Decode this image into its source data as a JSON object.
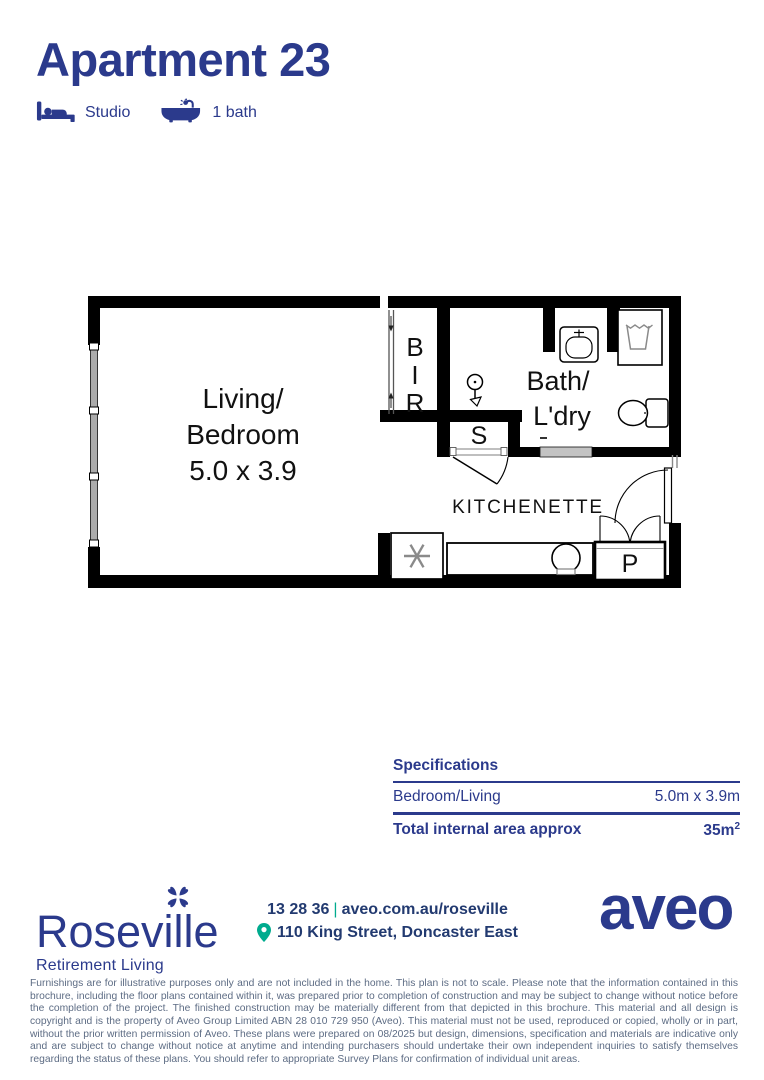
{
  "colors": {
    "navy": "#2b3a8c",
    "green": "#00ab8e",
    "disclaimer_gray": "#5d6c84",
    "wall": "#000000"
  },
  "header": {
    "title": "Apartment 23",
    "features": [
      {
        "icon": "bed-icon",
        "label": "Studio"
      },
      {
        "icon": "bath-icon",
        "label": "1 bath"
      }
    ]
  },
  "floorplan": {
    "labels": {
      "living_line1": "Living/",
      "living_line2": "Bedroom",
      "living_dims": "5.0 x 3.9",
      "bir": [
        "B",
        "I",
        "R"
      ],
      "storage": "S",
      "bath_line1": "Bath/",
      "bath_line2": "L'dry",
      "kitchenette": "KITCHENETTE",
      "pantry": "P"
    }
  },
  "specifications": {
    "heading": "Specifications",
    "rows": [
      {
        "label": "Bedroom/Living",
        "value": "5.0m x 3.9m"
      }
    ],
    "total": {
      "label": "Total internal area approx",
      "value": "35m",
      "sup": "2"
    }
  },
  "footer": {
    "community_name": "Roseville",
    "community_tagline": "Retirement Living",
    "phone": "13 28 36",
    "separator": "|",
    "website": "aveo.com.au/roseville",
    "address": "110 King Street, Doncaster East",
    "brand": "aveo"
  },
  "disclaimer": "Furnishings are for illustrative purposes only and are not included in the home. This plan is not to scale. Please note that the information contained in this brochure, including the floor plans contained within it, was prepared prior to completion of construction and may be subject to change without notice before the completion of the project. The finished construction may be materially different from that depicted in this brochure. This material and all design is copyright and is the property of Aveo Group Limited ABN 28 010 729 950 (Aveo). This material must not be used, reproduced or copied, wholly or in part, without the prior written permission of Aveo. These plans were prepared on 08/2025 but design, dimensions, specification and materials are indicative only and are subject to change without notice at anytime and intending purchasers should undertake their own independent inquiries to satisfy themselves regarding the status of these plans. You should refer to appropriate Survey Plans for confirmation of individual unit areas."
}
